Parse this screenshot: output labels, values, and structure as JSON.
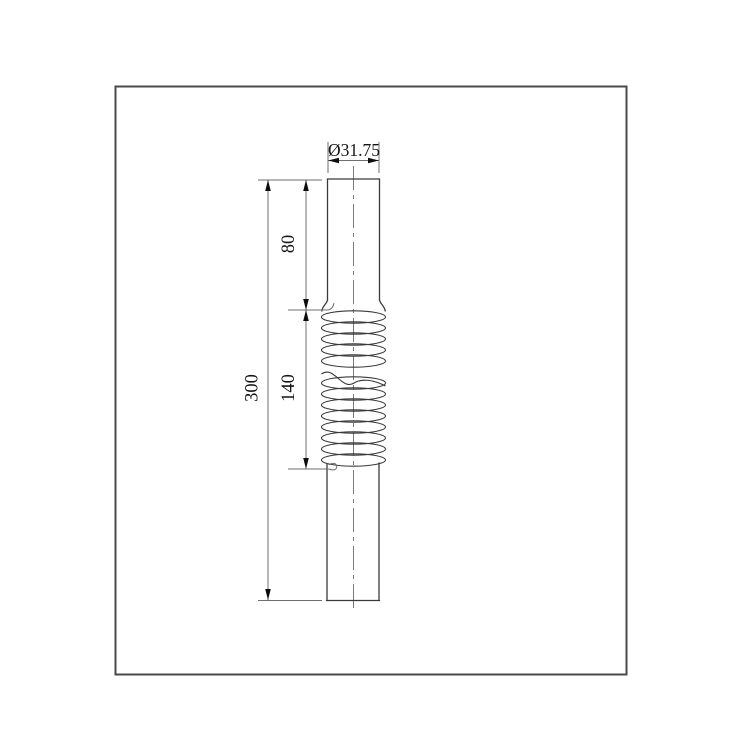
{
  "drawing": {
    "dimension_labels": {
      "diameter": "Ø31.75",
      "upper_segment_length": "80",
      "corrugated_segment_length": "140",
      "overall_length": "300"
    },
    "colors": {
      "background": "#ffffff",
      "part_outline": "#3a3a3a",
      "dimension_lines": "#6f6f6f",
      "centerline": "#7a7a7a",
      "arrowheads": "#0d0d0d",
      "text": "#141414",
      "border": "#4a4a4a"
    }
  }
}
